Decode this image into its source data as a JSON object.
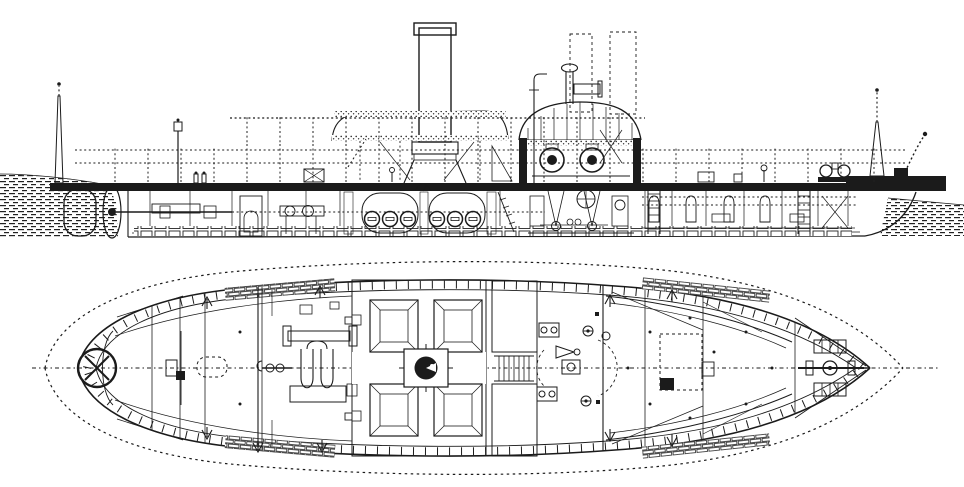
{
  "figure": {
    "kind": "technical-drawing",
    "subject": "Steam gunboat - inboard profile and deck plan",
    "views": {
      "side_elevation": {
        "aria": "Side elevation (inboard profile) view"
      },
      "deck_plan": {
        "aria": "Deck plan (top) view"
      }
    },
    "colors": {
      "background": "#ffffff",
      "ink": "#1b1b1b"
    }
  }
}
